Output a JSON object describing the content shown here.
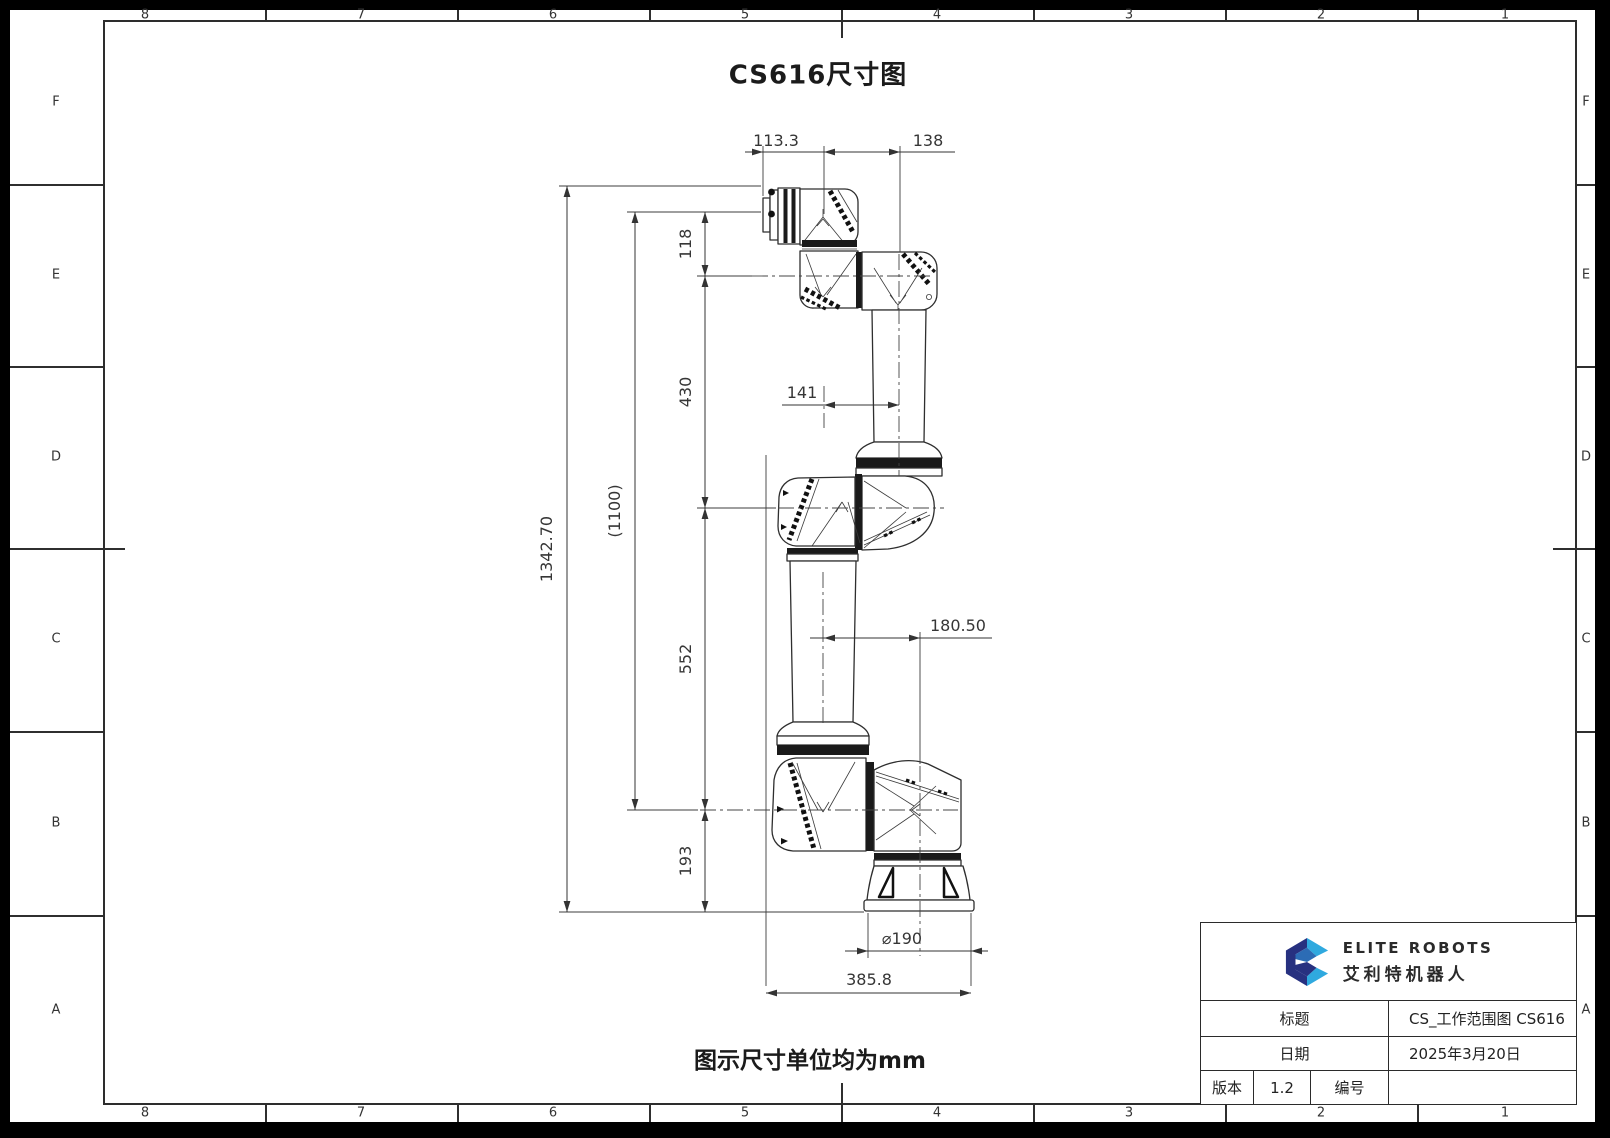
{
  "frame": {
    "zone_columns": [
      "8",
      "7",
      "6",
      "5",
      "4",
      "3",
      "2",
      "1"
    ],
    "zone_rows": [
      "F",
      "E",
      "D",
      "C",
      "B",
      "A"
    ]
  },
  "drawing": {
    "title": "CS616尺寸图",
    "unit_note": "图示尺寸单位均为mm"
  },
  "dimensions": {
    "flange_to_wrist": "113.3",
    "wrist_offset": "138",
    "wrist_height": "118",
    "upper_arm_length": "430",
    "elbow_offset": "141",
    "total_height": "1342.70",
    "reference_height": "(1100)",
    "forearm_length": "552",
    "base_offset": "180.50",
    "base_height": "193",
    "base_diameter": "⌀190",
    "base_width": "385.8"
  },
  "title_block": {
    "brand_en": "ELITE ROBOTS",
    "brand_cn": "艾利特机器人",
    "logo_colors": {
      "navy": "#273180",
      "cyan": "#2fa9df",
      "blue": "#2c6cb5"
    },
    "title_label": "标题",
    "title_value": "CS_工作范围图 CS616",
    "date_label": "日期",
    "date_value": "2025年3月20日",
    "version_label": "版本",
    "version_value": "1.2",
    "number_label": "编号",
    "number_value": ""
  }
}
